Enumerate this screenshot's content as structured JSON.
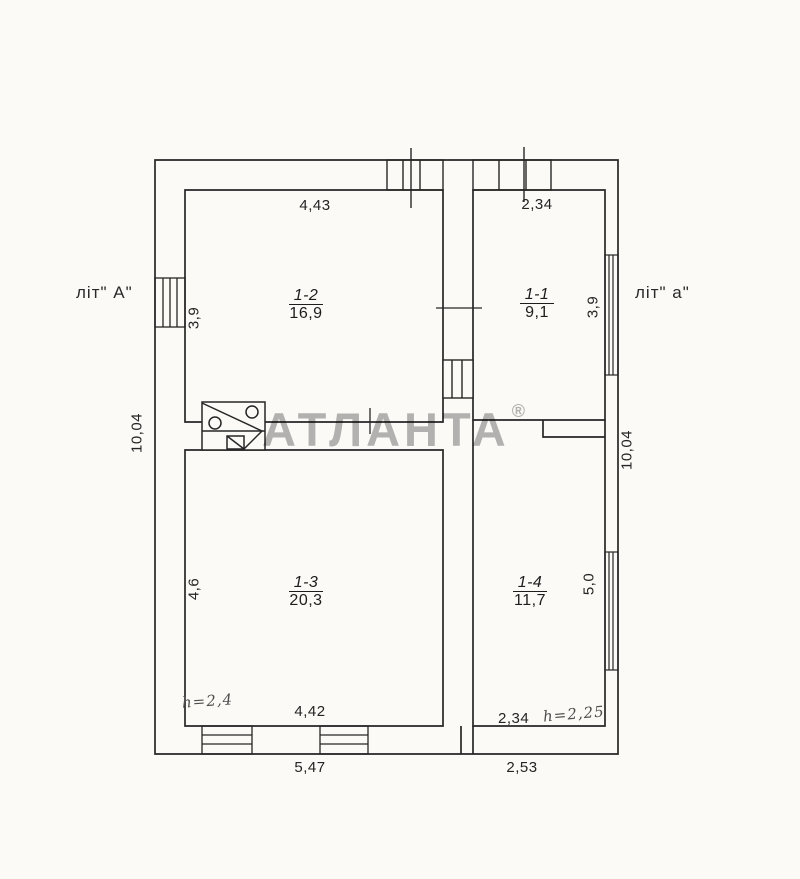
{
  "document_type": "floor plan (BTI technical passport drawing)",
  "watermark": {
    "text": "АТЛАНТА",
    "reg": "®"
  },
  "building": {
    "left_label": "літ\" А\"",
    "right_label": "літ\" а\""
  },
  "rooms": [
    {
      "number": "1-2",
      "area": "16,9"
    },
    {
      "number": "1-1",
      "area": "9,1"
    },
    {
      "number": "1-3",
      "area": "20,3"
    },
    {
      "number": "1-4",
      "area": "11,7"
    }
  ],
  "dims": {
    "top_left_width": "4,43",
    "top_right_width": "2,34",
    "left_upper_height": "3,9",
    "left_total_height": "10,04",
    "left_lower_height": "4,6",
    "right_upper_height": "3,9",
    "right_total_height": "10,04",
    "right_lower_height": "5,0",
    "bottom_left_width": "4,42",
    "bottom_right_width": "2,34",
    "bottom_total_left": "5,47",
    "bottom_total_right": "2,53"
  },
  "notes": {
    "left_ceiling_height": "h=2,4",
    "right_ceiling_height": "h=2,25"
  },
  "symbols": {
    "stove": "stove-symbol",
    "windows": "window-symbol",
    "door": "door-opening-symbol"
  },
  "colors": {
    "ink": "#262626",
    "paper": "#fbfaf7",
    "watermark": "#b5b5b5",
    "note_ink": "#4e4e4e"
  }
}
